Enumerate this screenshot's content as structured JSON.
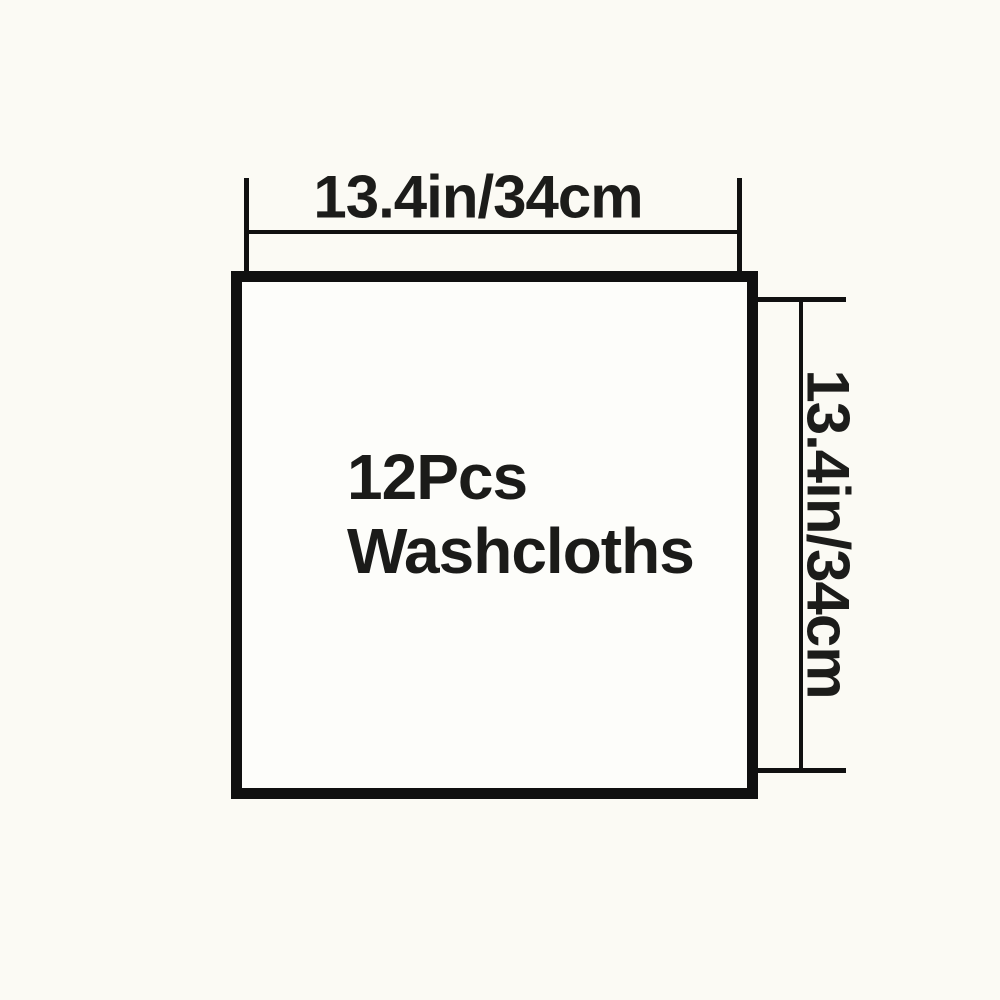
{
  "colors": {
    "background": "#fbfaf4",
    "line": "#101010",
    "text": "#1c1c1a"
  },
  "diagram": {
    "width_dimension_label": "13.4in/34cm",
    "height_dimension_label": "13.4in/34cm",
    "product": {
      "line1": "12Pcs",
      "line2": "Washcloths"
    }
  }
}
